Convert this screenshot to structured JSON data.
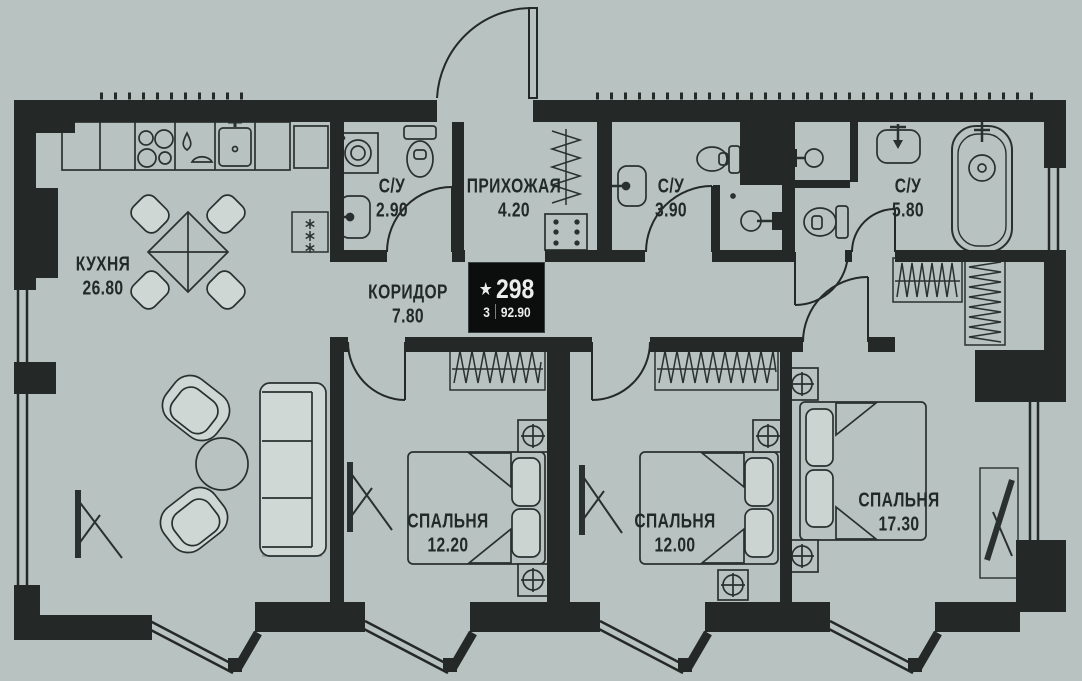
{
  "badge": {
    "star_icon": "★",
    "unit_number": "298",
    "rooms_count": "3",
    "total_area": "92.90"
  },
  "rooms": [
    {
      "id": "kitchen",
      "name": "КУХНЯ",
      "area": "26.80"
    },
    {
      "id": "bathroom-1",
      "name": "С/У",
      "area": "2.90"
    },
    {
      "id": "hallway",
      "name": "ПРИХОЖАЯ",
      "area": "4.20"
    },
    {
      "id": "bathroom-2",
      "name": "С/У",
      "area": "3.90"
    },
    {
      "id": "bathroom-3",
      "name": "С/У",
      "area": "5.80"
    },
    {
      "id": "corridor",
      "name": "КОРИДОР",
      "area": "7.80"
    },
    {
      "id": "bedroom-1",
      "name": "СПАЛЬНЯ",
      "area": "12.20"
    },
    {
      "id": "bedroom-2",
      "name": "СПАЛЬНЯ",
      "area": "12.00"
    },
    {
      "id": "bedroom-3",
      "name": "СПАЛЬНЯ",
      "area": "17.30"
    }
  ],
  "colors": {
    "background": "#b8c2c0",
    "walls": "#242928",
    "furniture_line": "#2a302f",
    "upholstery": "#d0d8d6",
    "badge_bg": "#0c0e0e",
    "badge_text": "#eaeeec"
  }
}
